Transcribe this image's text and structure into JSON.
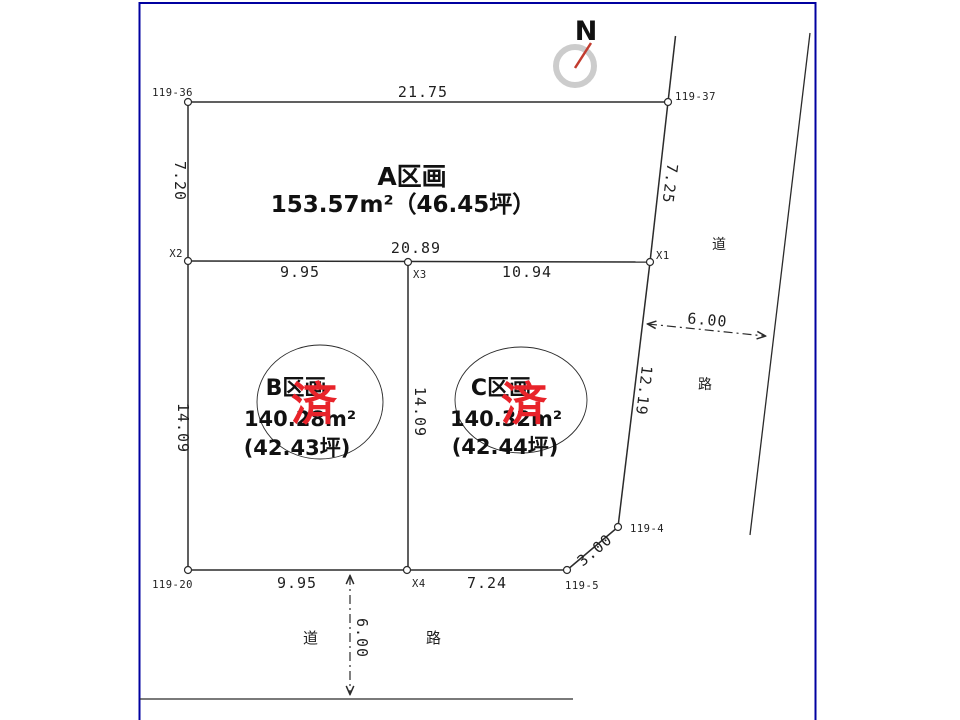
{
  "compass": {
    "label": "N"
  },
  "plots": {
    "a": {
      "name": "A区画",
      "area": "153.57m²（46.45坪）"
    },
    "b": {
      "name": "B区画",
      "area_m2": "140.28m²",
      "area_tsubo": "(42.43坪)",
      "stamp": "済"
    },
    "c": {
      "name": "C区画",
      "area_m2": "140.32m²",
      "area_tsubo": "(42.44坪)",
      "stamp": "済"
    }
  },
  "dimensions": {
    "top": "21.75",
    "left_upper": "7.20",
    "middle_total": "20.89",
    "middle_b": "9.95",
    "middle_c": "10.94",
    "left_lower": "14.09",
    "divider": "14.09",
    "bottom_b": "9.95",
    "bottom_c": "7.24",
    "right_upper": "7.25",
    "right_lower": "12.19",
    "corner_cut": "3.00",
    "right_road_width": "6.00",
    "bottom_road_width": "6.00"
  },
  "points": {
    "p119_36": "119-36",
    "p119_37": "119-37",
    "p119_20": "119-20",
    "p119_5": "119-5",
    "p119_4": "119-4",
    "x1": "X1",
    "x2": "X2",
    "x3": "X3",
    "x4": "X4"
  },
  "roads": {
    "right_1": "道",
    "right_2": "路",
    "bottom_1": "道",
    "bottom_2": "路"
  },
  "colors": {
    "frame_blue": "#0000a0",
    "line": "#2b2b2b",
    "stamp_red": "#e8232a",
    "needle_red": "#c23b2e",
    "compass_ring": "#cccccc"
  }
}
